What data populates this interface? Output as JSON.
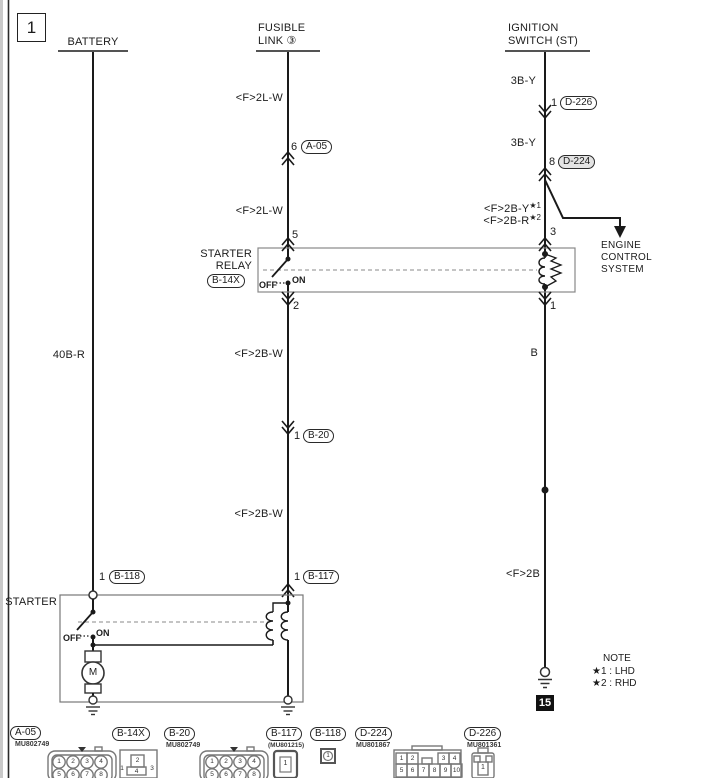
{
  "page": {
    "badge": "1"
  },
  "headers": {
    "battery": "BATTERY",
    "fusible1": "FUSIBLE",
    "fusible2": "LINK ③",
    "ignition1": "IGNITION",
    "ignition2": "SWITCH (ST)"
  },
  "wire_labels": {
    "w40br": "40B-R",
    "w2lw_a": "<F>2L-W",
    "w2lw_b": "<F>2L-W",
    "w2bw_a": "<F>2B-W",
    "w2bw_b": "<F>2B-W",
    "w3by_a": "3B-Y",
    "w3by_b": "3B-Y",
    "w2by": "<F>2B-Y",
    "w2by_sup": "★1",
    "w2br": "<F>2B-R",
    "w2br_sup": "★2",
    "wb": "B",
    "w2b": "<F>2B"
  },
  "pins": {
    "a05": "6",
    "d226": "1",
    "d224": "8",
    "relay5": "5",
    "relay3": "3",
    "relay2": "2",
    "relay1": "1",
    "b20": "1",
    "b117": "1",
    "b118": "1"
  },
  "refs": {
    "a05": "A-05",
    "d226": "D-226",
    "d224": "D-224",
    "b14x": "B-14X",
    "b20": "B-20",
    "b117": "B-117",
    "b118": "B-118"
  },
  "relay": {
    "name1": "STARTER",
    "name2": "RELAY",
    "off": "OFF",
    "on": "ON"
  },
  "starter": {
    "name": "STARTER",
    "off": "OFF",
    "on": "ON"
  },
  "motor": {
    "letter": "M"
  },
  "ecs": {
    "l1": "ENGINE",
    "l2": "CONTROL",
    "l3": "SYSTEM"
  },
  "ground": {
    "ref": "15"
  },
  "note": {
    "title": "NOTE",
    "l1": "★1 : LHD",
    "l2": "★2 : RHD"
  },
  "footer": [
    {
      "id": "A-05",
      "code": "MU802749",
      "pins": [
        "1",
        "2",
        "3",
        "4",
        "5",
        "6",
        "7",
        "8"
      ]
    },
    {
      "id": "B-14X",
      "code": "",
      "pins": [
        "2",
        "1",
        "4",
        "3"
      ]
    },
    {
      "id": "B-20",
      "code": "MU802749",
      "pins": [
        "1",
        "2",
        "3",
        "4",
        "5",
        "6",
        "7",
        "8"
      ]
    },
    {
      "id": "B-117",
      "code": "(MU801215)",
      "pins": [
        "1"
      ]
    },
    {
      "id": "B-118",
      "code": "",
      "pins": [
        "1"
      ]
    },
    {
      "id": "D-224",
      "code": "MU801867",
      "pins": [
        "1",
        "2",
        "3",
        "4",
        "5",
        "6",
        "7",
        "8",
        "9",
        "10"
      ]
    },
    {
      "id": "D-226",
      "code": "MU801361",
      "pins": [
        "1"
      ]
    }
  ]
}
